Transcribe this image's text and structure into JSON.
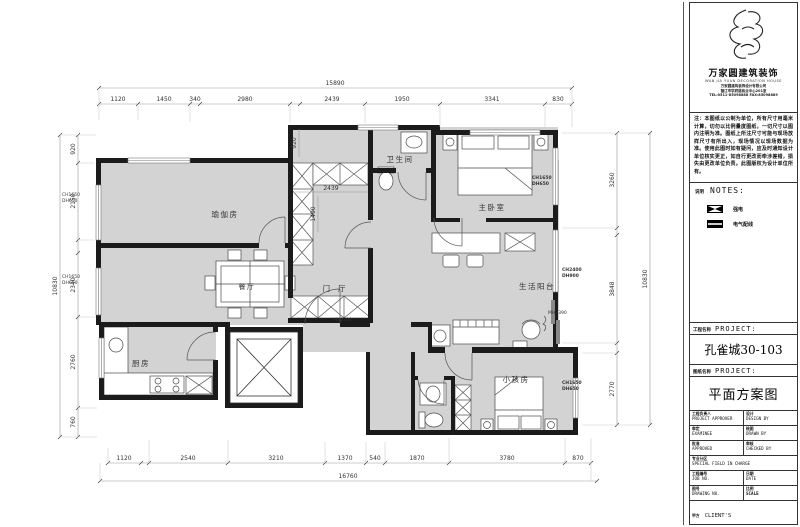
{
  "plan": {
    "rooms": {
      "yoga": "瑜伽房",
      "bath": "卫生间",
      "master": "主卧室",
      "dining": "餐厅",
      "hall": "门厅",
      "balcony": "生活阳台",
      "kitchen": "厨房",
      "kids": "小孩房"
    },
    "dims": {
      "top_total": "15890",
      "top": [
        "1120",
        "1450",
        "340",
        "2980",
        "2439",
        "1950",
        "3341",
        "830"
      ],
      "bottom": [
        "1120",
        "2540",
        "3210",
        "1370",
        "540",
        "1870",
        "3780",
        "870"
      ],
      "bottom_total": "16760",
      "left": [
        "920",
        "2150",
        "2340",
        "2760",
        "760"
      ],
      "left_total": "10830",
      "right": [
        "3260",
        "3848",
        "2770"
      ],
      "right_total": "10830",
      "inner_920": "920",
      "inner_2439": "2439",
      "inner_1490": "1490"
    },
    "markers": {
      "left1": {
        "l1": "CH1650",
        "l2": "DH650"
      },
      "left2": {
        "l1": "CH1650",
        "l2": "DH650"
      },
      "master": {
        "l1": "CH1650",
        "l2": "DH650"
      },
      "balcony": {
        "l1": "CH2400",
        "l2": "DH900"
      },
      "kids": {
        "l1": "CH1650",
        "l2": "DH650"
      },
      "door1": "MH2200",
      "door2": "MH2390"
    }
  },
  "title_block": {
    "logo": {
      "company_cn": "万家圆建筑装饰",
      "company_en": "WAN JIA YUAN DECORATION HOUSE",
      "addr1": "万家圆建筑装饰设计有限公司",
      "addr2": "镇江市学府路商业中心201室",
      "addr3": "TEL:0511-85098888 FAX:85098889"
    },
    "disclaimer": "注：本图纸以公制为单位，所有尺寸用毫米计算，切勿以比例量度图纸，一切尺寸以图内注明为准。图纸上所注尺寸可能与现场放样尺寸有所出入，现场情况以现场数据为准。使用此图时如有疑问，应及时通知设计单位核实更正，如自行更改而牵涉差错，损失由更改单位负责。此图版权为设计单位所有。",
    "notes": {
      "label_cn": "说明",
      "label_en": "NOTES:"
    },
    "legend": [
      {
        "label": "强电"
      },
      {
        "label": "电气配线"
      }
    ],
    "project": {
      "label_cn": "工程名称",
      "label_en": "PROJECT:",
      "value": "孔雀城30-103"
    },
    "drawing": {
      "label_cn": "图纸名称",
      "label_en": "PROJECT:",
      "value": "平面方案图"
    },
    "table": {
      "rows": [
        {
          "c1_cn": "工程负责人",
          "c1_en": "PROJECT APPROVER",
          "c2_cn": "设计",
          "c2_en": "DESIGN BY"
        },
        {
          "c1_cn": "审定",
          "c1_en": "EXAMINEE",
          "c2_cn": "绘图",
          "c2_en": "DRAWN BY"
        },
        {
          "c1_cn": "批准",
          "c1_en": "APPROVED",
          "c2_cn": "审核",
          "c2_en": "CHECKED BY"
        },
        {
          "c1_cn": "专业分区",
          "c1_en": "SPECIAL FIELD IN CHARGE"
        },
        {
          "c1_cn": "工程编号",
          "c1_en": "JOB NO.",
          "c2_cn": "日期",
          "c2_en": "DATE"
        },
        {
          "c1_cn": "图号",
          "c1_en": "DRAWING NO.",
          "c2_cn": "比例",
          "c2_en": "SCALE"
        }
      ],
      "client": {
        "cn": "甲方",
        "en": "CLIENT'S"
      }
    }
  }
}
